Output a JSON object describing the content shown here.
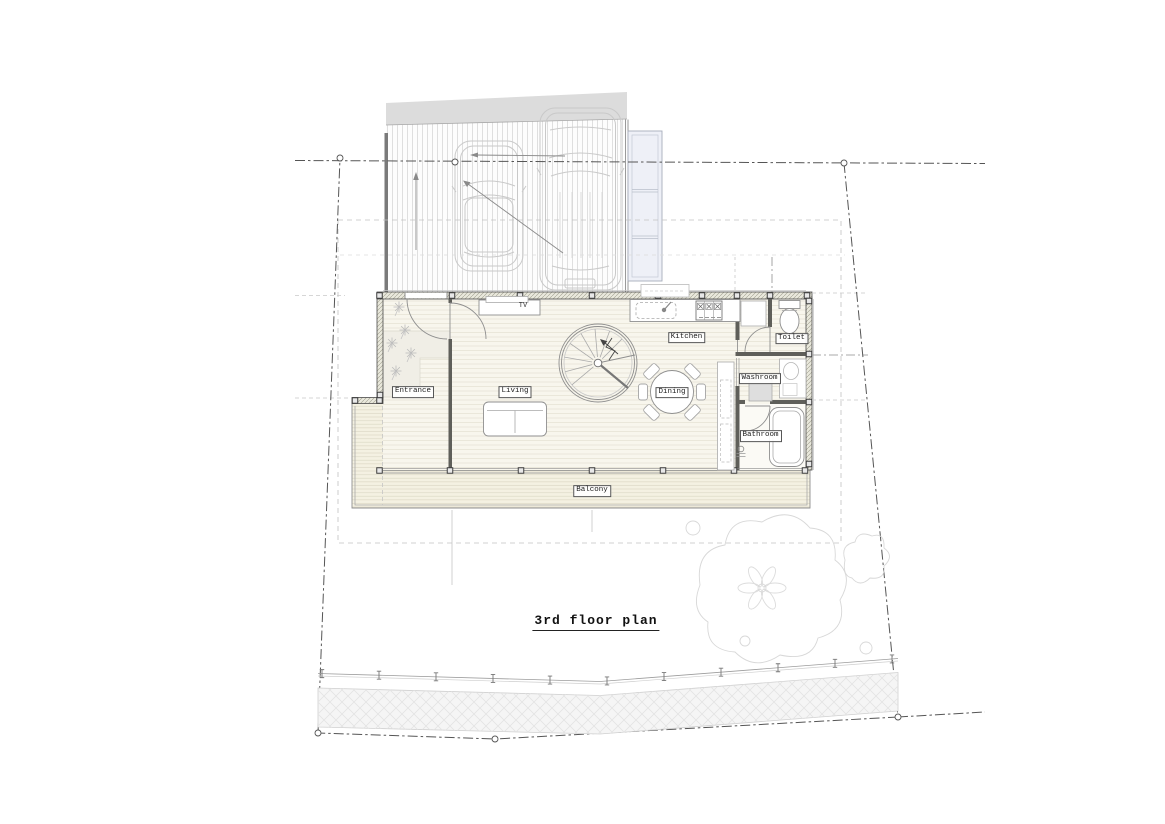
{
  "drawing": {
    "title": "3rd floor plan",
    "labels": {
      "entrance": "Entrance",
      "living": "Living",
      "dining": "Dining",
      "kitchen": "Kitchen",
      "toilet": "Toilet",
      "washroom": "Washroom",
      "bathroom": "Bathroom",
      "balcony": "Balcony",
      "tv": "TV"
    },
    "colors": {
      "paper": "#ffffff",
      "line_dark": "#4a4a4a",
      "line_light": "#c9c9c9",
      "floor": "#f8f6ed",
      "deck": "#f5f2e4",
      "wall_hatch": "#a09f8f",
      "neighbor_gray": "#dcdcdc",
      "stair_structure": "#eef0f7"
    }
  }
}
